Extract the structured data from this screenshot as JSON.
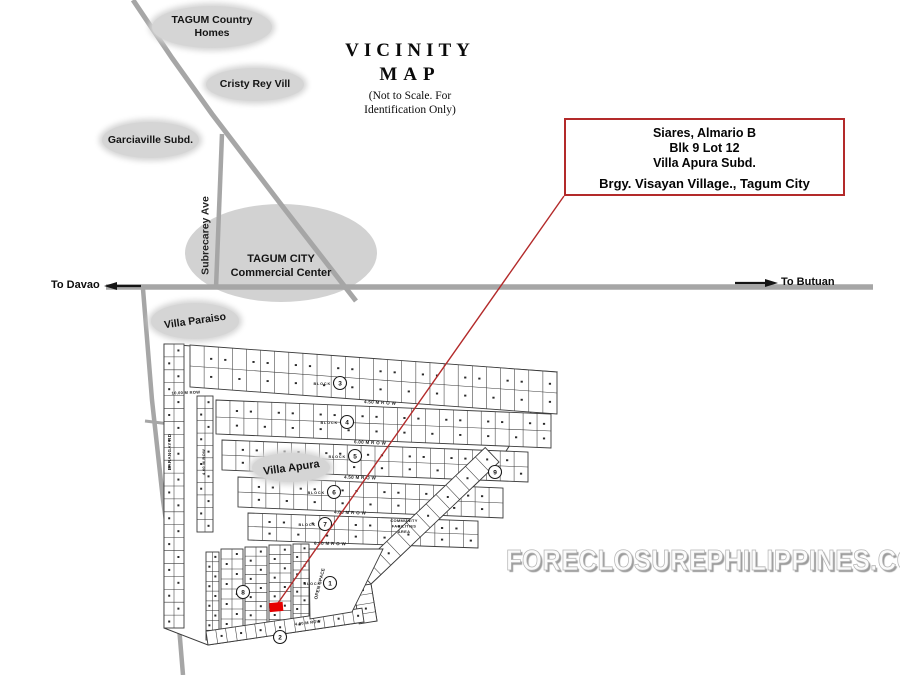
{
  "title": {
    "line1": "VICINITY",
    "line2": "MAP",
    "note1": "(Not to Scale. For",
    "note2": "Identification Only)"
  },
  "labels": {
    "tagum_country_homes_line1": "TAGUM Country",
    "tagum_country_homes_line2": "Homes",
    "cristy_rey": "Cristy Rey Vill",
    "garciaville": "Garciaville Subd.",
    "commercial_center_line1": "TAGUM CITY",
    "commercial_center_line2": "Commercial Center",
    "villa_paraiso": "Villa Paraiso",
    "villa_apura": "Villa Apura",
    "subrecarey_ave": "Subrecarey Ave",
    "to_davao": "To Davao",
    "to_butuan": "To Butuan"
  },
  "info_box": {
    "line1": "Siares, Almario B",
    "line2": "Blk 9 Lot 12",
    "line3": "Villa Apura  Subd.",
    "line4": "Brgy. Visayan Village., Tagum City"
  },
  "watermark": "FORECLOSUREPHILIPPINES.COM",
  "colors": {
    "road_gray": "#a6a6a6",
    "label_ellipse_gray": "#d5d5d5",
    "highlight_red": "#b32a2a",
    "lot_marker_red": "#e60000",
    "map_ink": "#3b3b3b"
  },
  "plat": {
    "ink": "#3b3b3b",
    "block_word": "BLOCK",
    "boundary": [
      [
        164,
        344
      ],
      [
        557,
        372
      ],
      [
        499,
        462
      ],
      [
        371,
        584
      ],
      [
        377,
        621
      ],
      [
        364,
        622
      ],
      [
        208,
        645
      ],
      [
        164,
        628
      ]
    ],
    "rows": [
      {
        "x1": 190,
        "y1": 345,
        "x2": 557,
        "y2": 372,
        "h": 42,
        "lots": 26
      },
      {
        "x1": 216,
        "y1": 400,
        "x2": 551,
        "y2": 414,
        "h": 34,
        "lots": 24
      },
      {
        "x1": 222,
        "y1": 440,
        "x2": 528,
        "y2": 452,
        "h": 30,
        "lots": 22
      },
      {
        "x1": 238,
        "y1": 477,
        "x2": 503,
        "y2": 488,
        "h": 30,
        "lots": 19
      },
      {
        "x1": 248,
        "y1": 513,
        "x2": 478,
        "y2": 521,
        "h": 27,
        "lots": 16
      }
    ],
    "columns": [
      {
        "x": 206,
        "y": 552,
        "w": 13,
        "h": 88,
        "cells": 9
      },
      {
        "x": 221,
        "y": 549,
        "w": 22,
        "h": 80,
        "cells": 8
      },
      {
        "x": 245,
        "y": 547,
        "w": 22,
        "h": 82,
        "cells": 9
      },
      {
        "x": 269,
        "y": 545,
        "w": 22,
        "h": 84,
        "cells": 9
      },
      {
        "x": 293,
        "y": 544,
        "w": 16,
        "h": 78,
        "cells": 9
      },
      {
        "x": 164,
        "y": 344,
        "w": 20,
        "h": 284,
        "cells": 22
      },
      {
        "x": 197,
        "y": 396,
        "w": 16,
        "h": 136,
        "cells": 11
      }
    ],
    "bands": [
      {
        "x1": 499,
        "y1": 462,
        "x2": 371,
        "y2": 584,
        "w": 20,
        "lots": 13
      },
      {
        "x1": 371,
        "y1": 584,
        "x2": 377,
        "y2": 621,
        "w": 18,
        "lots": 4
      },
      {
        "x1": 364,
        "y1": 622,
        "x2": 208,
        "y2": 645,
        "w": 14,
        "lots": 16
      }
    ],
    "open_space": [
      [
        309,
        549
      ],
      [
        383,
        549
      ],
      [
        352,
        612
      ],
      [
        310,
        619
      ]
    ],
    "circles": [
      {
        "cx": 340,
        "cy": 383,
        "n": "3",
        "block": true
      },
      {
        "cx": 347,
        "cy": 422,
        "n": "4",
        "block": true
      },
      {
        "cx": 355,
        "cy": 456,
        "n": "5",
        "block": true
      },
      {
        "cx": 334,
        "cy": 492,
        "n": "6",
        "block": true
      },
      {
        "cx": 325,
        "cy": 524,
        "n": "7",
        "block": true
      },
      {
        "cx": 243,
        "cy": 592,
        "n": "8",
        "block": false
      },
      {
        "cx": 330,
        "cy": 583,
        "n": "1",
        "block": true
      },
      {
        "cx": 495,
        "cy": 472,
        "n": "9",
        "block": false
      },
      {
        "cx": 280,
        "cy": 637,
        "n": "2",
        "block": false
      }
    ],
    "texts": [
      {
        "x": 380,
        "y": 404,
        "t": "4.50 M  R O W",
        "r": 3,
        "s": 4.5
      },
      {
        "x": 370,
        "y": 444,
        "t": "6.00 M  R O W",
        "r": 2.5,
        "s": 4.5
      },
      {
        "x": 360,
        "y": 479,
        "t": "4.50 M  R O W",
        "r": 2,
        "s": 4.5
      },
      {
        "x": 350,
        "y": 514,
        "t": "4.00 M  R O W",
        "r": 2,
        "s": 4.5
      },
      {
        "x": 330,
        "y": 545,
        "t": "6.00 M  R O W",
        "r": 1,
        "s": 4.5
      },
      {
        "x": 186,
        "y": 394,
        "t": "10.00 M ROW",
        "r": -2,
        "s": 4
      },
      {
        "x": 308,
        "y": 624,
        "t": "4.00 M ROW",
        "r": -7,
        "s": 4
      },
      {
        "x": 171,
        "y": 452,
        "t": "BARANGAY RD",
        "r": -90,
        "s": 4.5
      },
      {
        "x": 205,
        "y": 462,
        "t": "4.00 M ROW",
        "r": -90,
        "s": 4
      },
      {
        "x": 321,
        "y": 584,
        "t": "OPEN SPACE",
        "r": -76,
        "s": 4.5
      },
      {
        "x": 404,
        "y": 522,
        "t": "COMMUNITY",
        "r": 0,
        "s": 4
      },
      {
        "x": 404,
        "y": 527.5,
        "t": "FACILITIES",
        "r": 0,
        "s": 4
      },
      {
        "x": 404,
        "y": 533,
        "t": "AREA",
        "r": 0,
        "s": 4
      }
    ],
    "red_lot": {
      "x": 269.5,
      "y": 602.5,
      "w": 13.5,
      "h": 9,
      "rot": -5
    },
    "red_line": {
      "x1": 564,
      "y1": 196,
      "x2": 278,
      "y2": 603
    }
  }
}
